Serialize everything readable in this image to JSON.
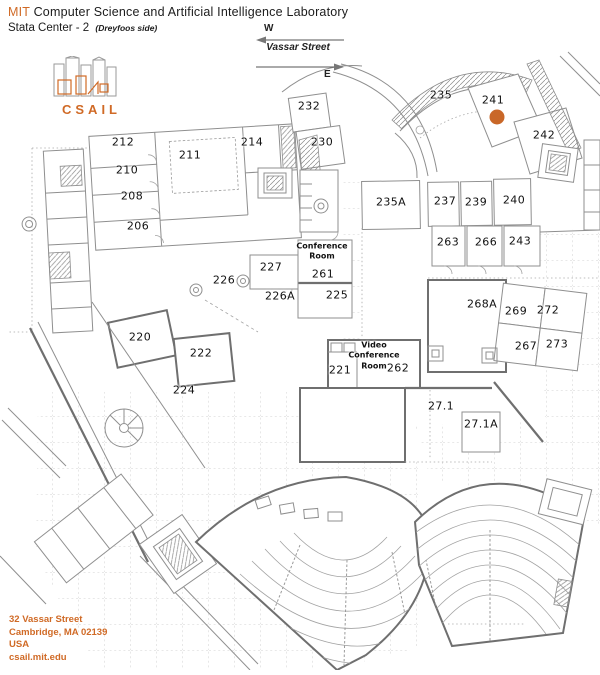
{
  "header": {
    "org": "MIT",
    "title": " Computer Science and Artificial Intelligence Laboratory",
    "building": "Stata Center - 2",
    "note": "(Dreyfoos side)"
  },
  "compass": {
    "west": "W",
    "east": "E",
    "street": "Vassar Street"
  },
  "logo": {
    "wordmark": "CSAIL"
  },
  "footer": {
    "line1": "32 Vassar Street",
    "line2": "Cambridge, MA 02139",
    "line3": "USA",
    "line4": "csail.mit.edu"
  },
  "colors": {
    "accent": "#d06a26",
    "marker": "#c96728",
    "wall": "#8f8f8f"
  },
  "map": {
    "marker": {
      "x": 497,
      "y": 117,
      "color": "#c96728"
    },
    "rooms": [
      {
        "label": "212",
        "x": 123,
        "y": 143
      },
      {
        "label": "211",
        "x": 190,
        "y": 156
      },
      {
        "label": "214",
        "x": 252,
        "y": 143
      },
      {
        "label": "232",
        "x": 309,
        "y": 107
      },
      {
        "label": "230",
        "x": 322,
        "y": 143
      },
      {
        "label": "210",
        "x": 127,
        "y": 171
      },
      {
        "label": "208",
        "x": 132,
        "y": 197
      },
      {
        "label": "206",
        "x": 138,
        "y": 227
      },
      {
        "label": "235",
        "x": 441,
        "y": 96
      },
      {
        "label": "241",
        "x": 493,
        "y": 101
      },
      {
        "label": "242",
        "x": 544,
        "y": 136
      },
      {
        "label": "235A",
        "x": 391,
        "y": 203
      },
      {
        "label": "237",
        "x": 445,
        "y": 202
      },
      {
        "label": "239",
        "x": 476,
        "y": 203
      },
      {
        "label": "240",
        "x": 514,
        "y": 201
      },
      {
        "label": "263",
        "x": 448,
        "y": 243
      },
      {
        "label": "266",
        "x": 486,
        "y": 243
      },
      {
        "label": "243",
        "x": 520,
        "y": 242
      },
      {
        "label": "268A",
        "x": 482,
        "y": 305
      },
      {
        "label": "269",
        "x": 516,
        "y": 312
      },
      {
        "label": "272",
        "x": 548,
        "y": 311
      },
      {
        "label": "267",
        "x": 526,
        "y": 347
      },
      {
        "label": "273",
        "x": 557,
        "y": 345
      },
      {
        "label": "227",
        "x": 271,
        "y": 268
      },
      {
        "label": "226",
        "x": 224,
        "y": 281
      },
      {
        "label": "226A",
        "x": 280,
        "y": 297
      },
      {
        "label": "Conference\nRoom",
        "x": 322,
        "y": 252,
        "small": true
      },
      {
        "label": "261",
        "x": 323,
        "y": 275
      },
      {
        "label": "225",
        "x": 337,
        "y": 296
      },
      {
        "label": "220",
        "x": 140,
        "y": 338
      },
      {
        "label": "222",
        "x": 201,
        "y": 354
      },
      {
        "label": "224",
        "x": 184,
        "y": 391
      },
      {
        "label": "221",
        "x": 340,
        "y": 371
      },
      {
        "label": "Video\nConference\nRoom",
        "x": 374,
        "y": 356,
        "small": true
      },
      {
        "label": "262",
        "x": 398,
        "y": 369
      },
      {
        "label": "27.1",
        "x": 441,
        "y": 407
      },
      {
        "label": "27.1A",
        "x": 481,
        "y": 425
      }
    ]
  }
}
